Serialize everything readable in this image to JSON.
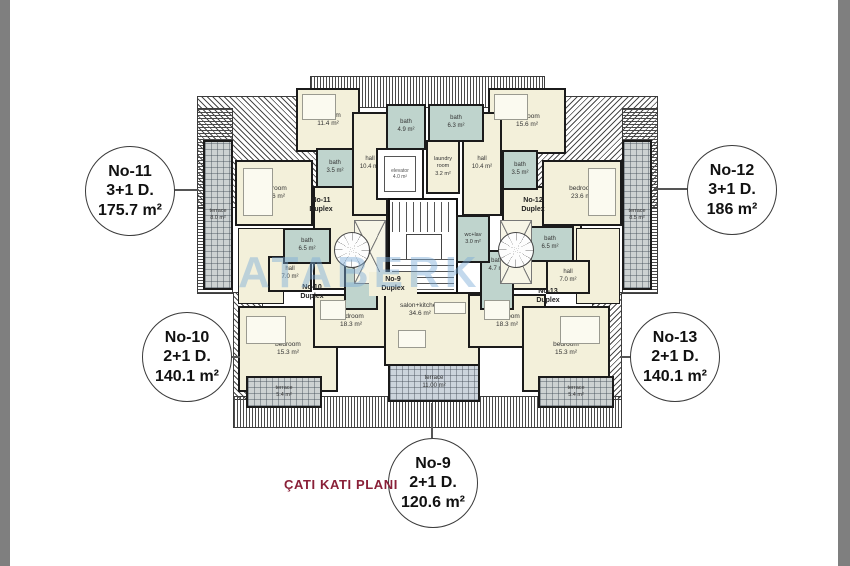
{
  "title": {
    "text": "ÇATI KATI PLANI"
  },
  "watermark": {
    "text": "ATABERK"
  },
  "colors": {
    "title": "#8a2038",
    "room_fill": "#f3f0da",
    "bath_fill": "#bfd4cd",
    "terrace_fill": "#cdd2d2",
    "watermark": "#7baad6"
  },
  "callouts": {
    "no11": {
      "name": "No-11",
      "type": "3+1 D.",
      "area": "175.7 m²"
    },
    "no12": {
      "name": "No-12",
      "type": "3+1 D.",
      "area": "186 m²"
    },
    "no10": {
      "name": "No-10",
      "type": "2+1 D.",
      "area": "140.1 m²"
    },
    "no13": {
      "name": "No-13",
      "type": "2+1 D.",
      "area": "140.1 m²"
    },
    "no9": {
      "name": "No-9",
      "type": "2+1 D.",
      "area": "120.6 m²"
    }
  },
  "duplex_labels": {
    "no11": {
      "line1": "No-11",
      "line2": "Duplex"
    },
    "no12": {
      "line1": "No-12",
      "line2": "Duplex"
    },
    "no10": {
      "line1": "No-10",
      "line2": "Duplex"
    },
    "no13": {
      "line1": "No-13",
      "line2": "Duplex"
    },
    "no9": {
      "line1": "No-9",
      "line2": "Duplex"
    }
  },
  "rooms": {
    "bedroom_11_4": {
      "label": "bedroom",
      "area": "11.4 m²"
    },
    "bath_3_5_left": {
      "label": "bath",
      "area": "3.5 m²"
    },
    "hall_10_4_left": {
      "label": "hall",
      "area": "10.4 m²"
    },
    "bedroom_23_6_left": {
      "label": "bedroom",
      "area": "23.6 m²"
    },
    "terrace_8_0": {
      "label": "terrace",
      "area": "8.0 m²"
    },
    "bath_4_9": {
      "label": "bath",
      "area": "4.9 m²"
    },
    "bath_6_3": {
      "label": "bath",
      "area": "6.3 m²"
    },
    "elevator": {
      "label": "elevator",
      "area": "4.0 m²"
    },
    "laundry_room": {
      "label": "laundry room",
      "area": "3.2 m²"
    },
    "hall_10_4_right": {
      "label": "hall",
      "area": "10.4 m²"
    },
    "bedroom_15_6": {
      "label": "bedroom",
      "area": "15.6 m²"
    },
    "bath_3_5_right": {
      "label": "bath",
      "area": "3.5 m²"
    },
    "bedroom_23_6_right": {
      "label": "bedroom",
      "area": "23.6 m²"
    },
    "terrace_8_5": {
      "label": "terrace",
      "area": "8.5 m²"
    },
    "bath_6_5_left": {
      "label": "bath",
      "area": "6.5 m²"
    },
    "hall_7_0_left": {
      "label": "hall",
      "area": "7.0 m²"
    },
    "bath_4_7_left": {
      "label": "bath",
      "area": "4.7 m²"
    },
    "wc_lav": {
      "label": "wc+lav",
      "area": "3.0 m²"
    },
    "bath_6_5_right": {
      "label": "bath",
      "area": "6.5 m²"
    },
    "bath_4_7_right": {
      "label": "bath",
      "area": "4.7 m²"
    },
    "hall_7_0_right": {
      "label": "hall",
      "area": "7.0 m²"
    },
    "bedroom_18_3_left": {
      "label": "bedroom",
      "area": "18.3 m²"
    },
    "bedroom_15_3_left": {
      "label": "bedroom",
      "area": "15.3 m²"
    },
    "terrace_5_4_left": {
      "label": "terrace",
      "area": "5.4 m²"
    },
    "salon_kitchen": {
      "label": "salon+kitchen",
      "area": "34.6 m²"
    },
    "terrace_11_0": {
      "label": "terrace",
      "area": "11.00 m²"
    },
    "bedroom_18_3_right": {
      "label": "bedroom",
      "area": "18.3 m²"
    },
    "bedroom_15_3_right": {
      "label": "bedroom",
      "area": "15.3 m²"
    },
    "terrace_5_4_right": {
      "label": "terrace",
      "area": "5.4 m²"
    }
  }
}
